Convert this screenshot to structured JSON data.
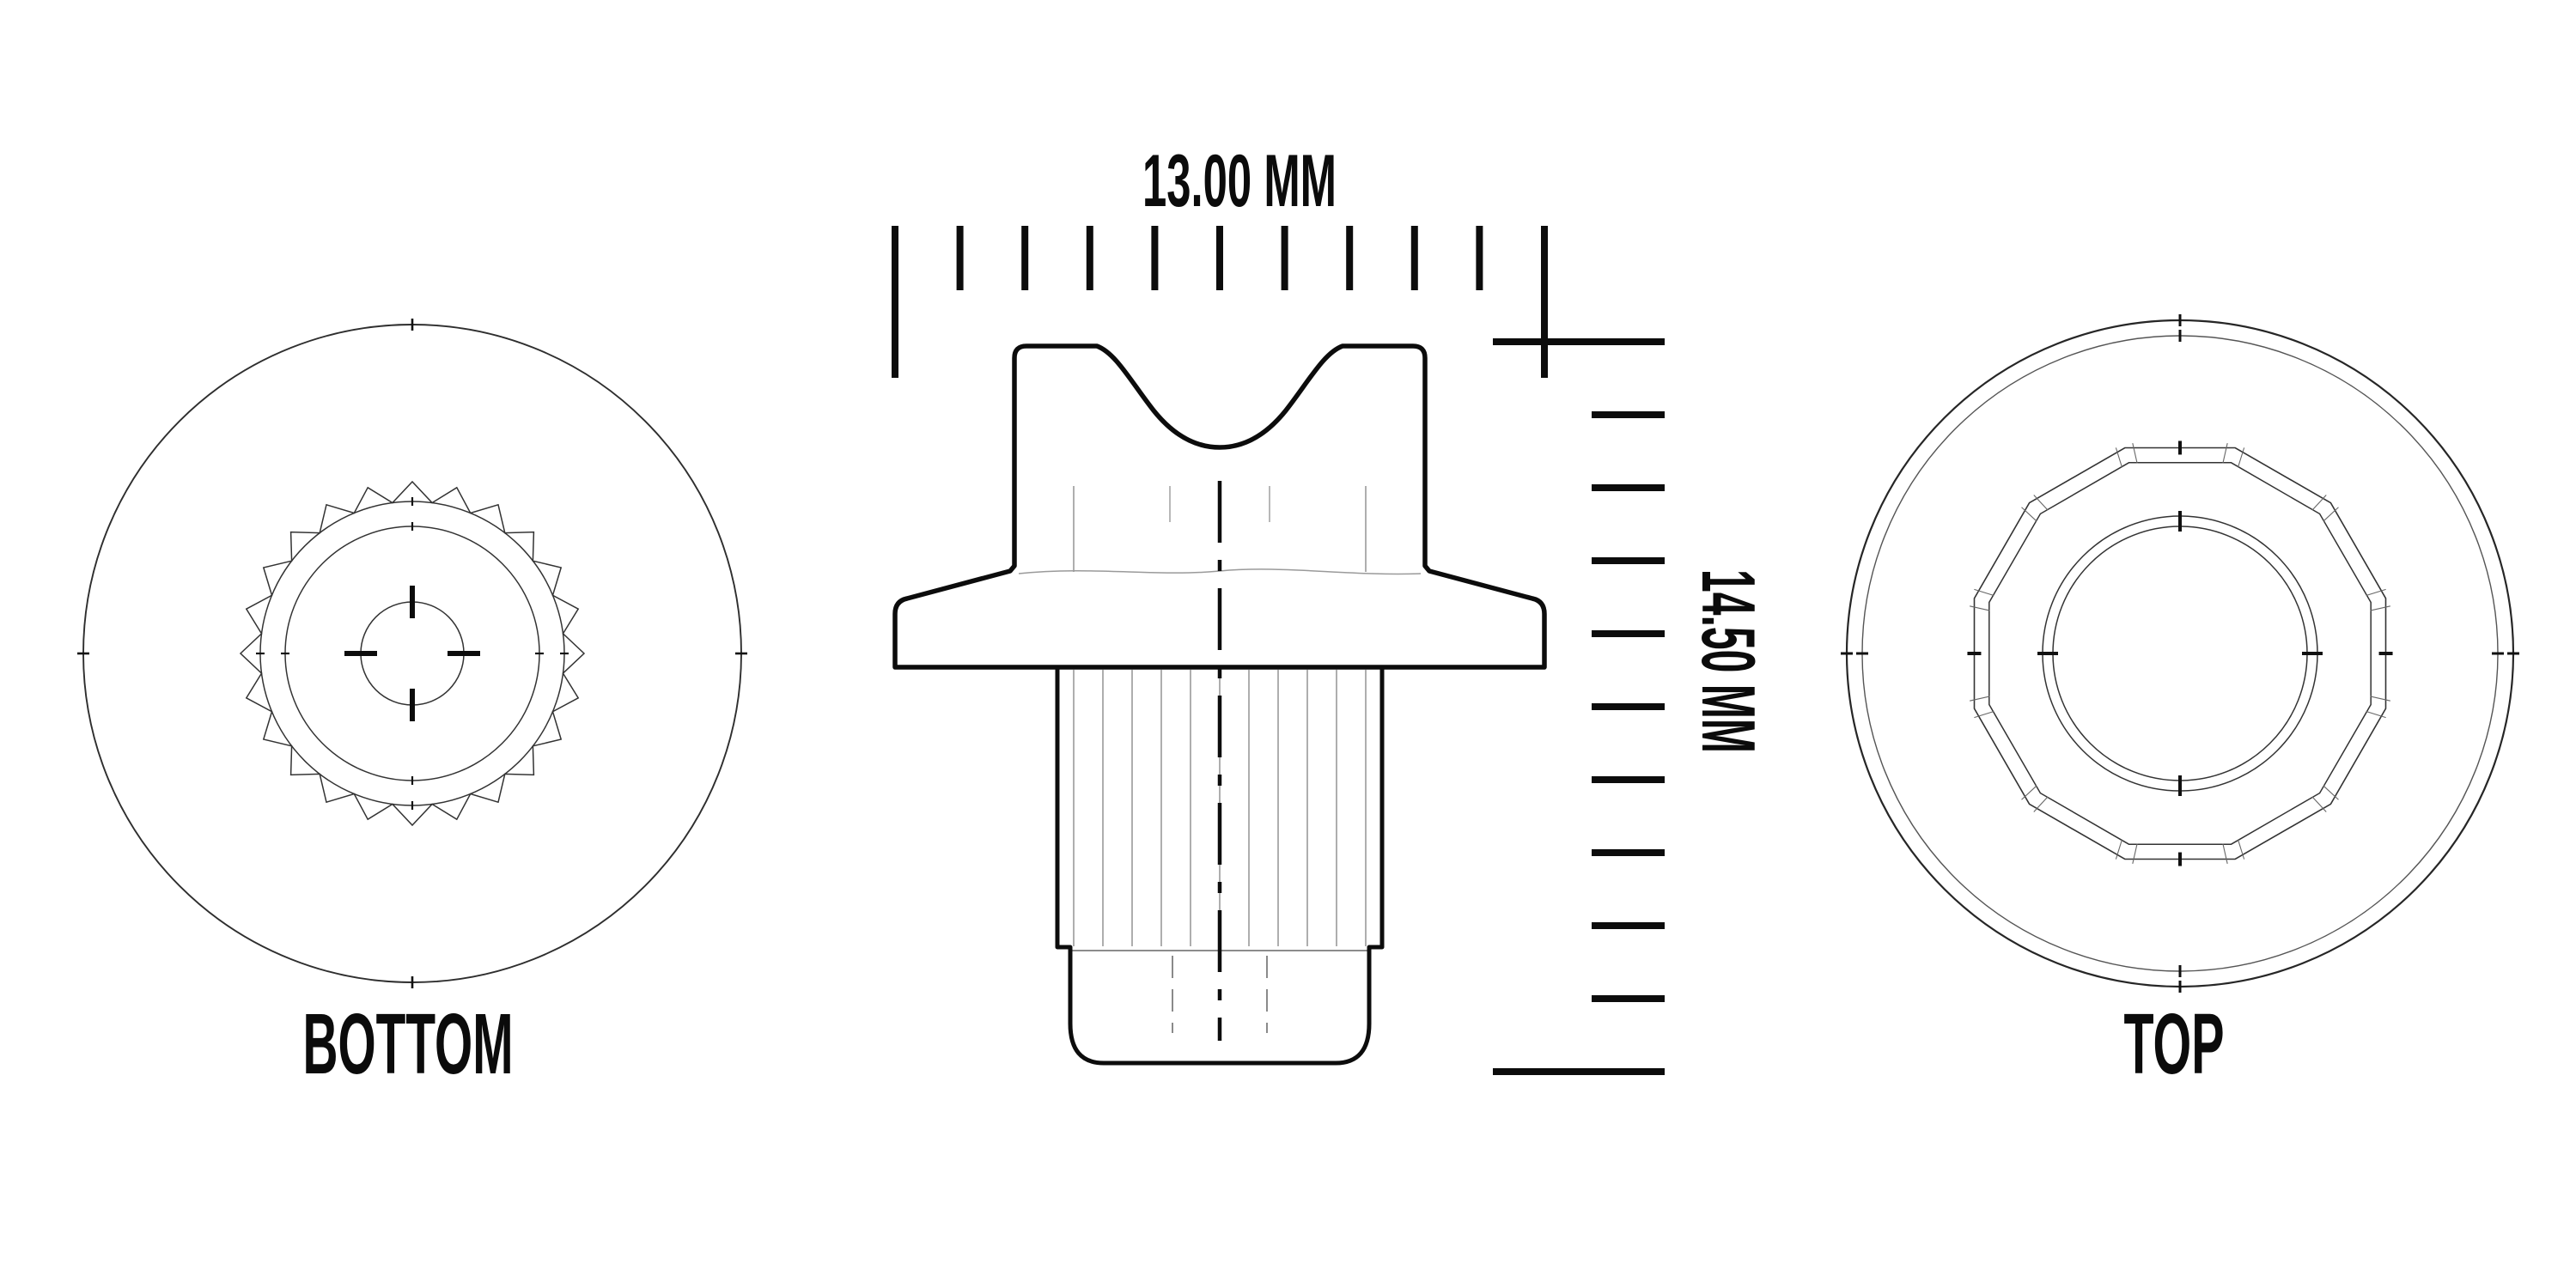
{
  "drawing": {
    "dimensions": {
      "width": "13.00 MM",
      "height": "14.50 MM"
    },
    "view_labels": {
      "bottom": "BOTTOM",
      "top": "TOP"
    },
    "rulers": {
      "horizontal": {
        "label": "13.00 MM",
        "intervals": 10
      },
      "vertical": {
        "label": "14.50 MM",
        "intervals": 10
      }
    },
    "bottom_view": {
      "teeth": 24
    },
    "top_view": {
      "polygon_sides": 12
    },
    "side_view": {
      "spline_lines": 11
    },
    "colors": {
      "ink": "#0c0c0c",
      "line": "#2e2e2e",
      "mid": "#555555",
      "faint": "#9a9a9a",
      "background": "#ffffff"
    }
  }
}
